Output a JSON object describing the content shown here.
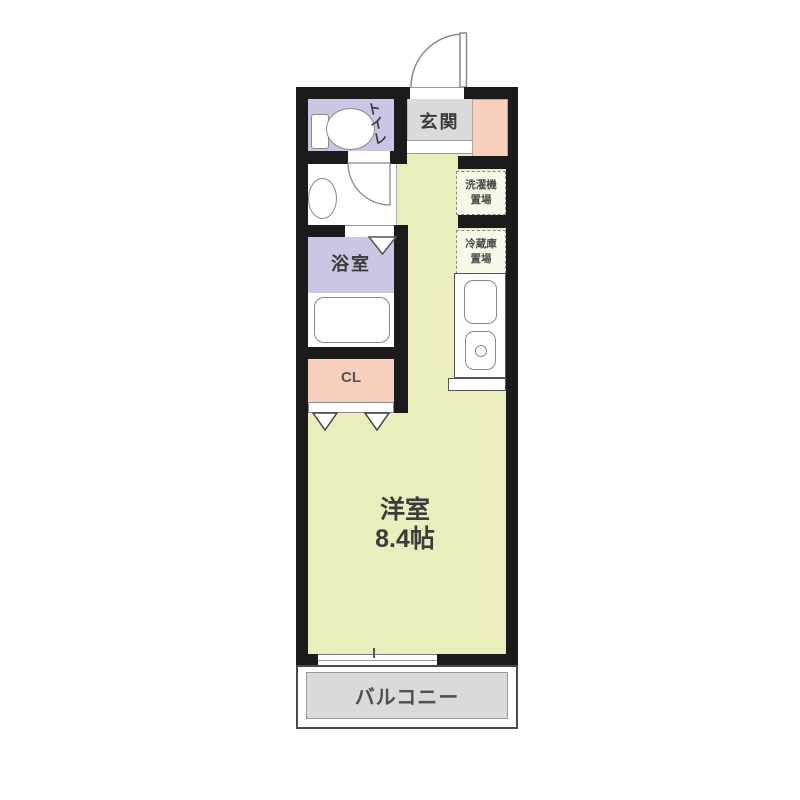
{
  "colors": {
    "wall": "#1b1b1b",
    "room-yellow": "#ecedbd",
    "wet-lavender": "#c9c7e3",
    "accent-salmon": "#f7cfba",
    "floor-gray": "#dadada",
    "outline-gray": "#8a8a8a",
    "text-dark": "#3c3c3c"
  },
  "rooms": {
    "toilet": {
      "label": "トイレ"
    },
    "entrance": {
      "label": "玄関"
    },
    "bathroom": {
      "label": "浴室"
    },
    "closet": {
      "label": "CL"
    },
    "washer_space": {
      "line1": "洗濯機",
      "line2": "置場"
    },
    "fridge_space": {
      "line1": "冷蔵庫",
      "line2": "置場"
    },
    "main_room": {
      "name": "洋室",
      "size": "8.4帖"
    },
    "balcony": {
      "label": "バルコニー"
    }
  }
}
